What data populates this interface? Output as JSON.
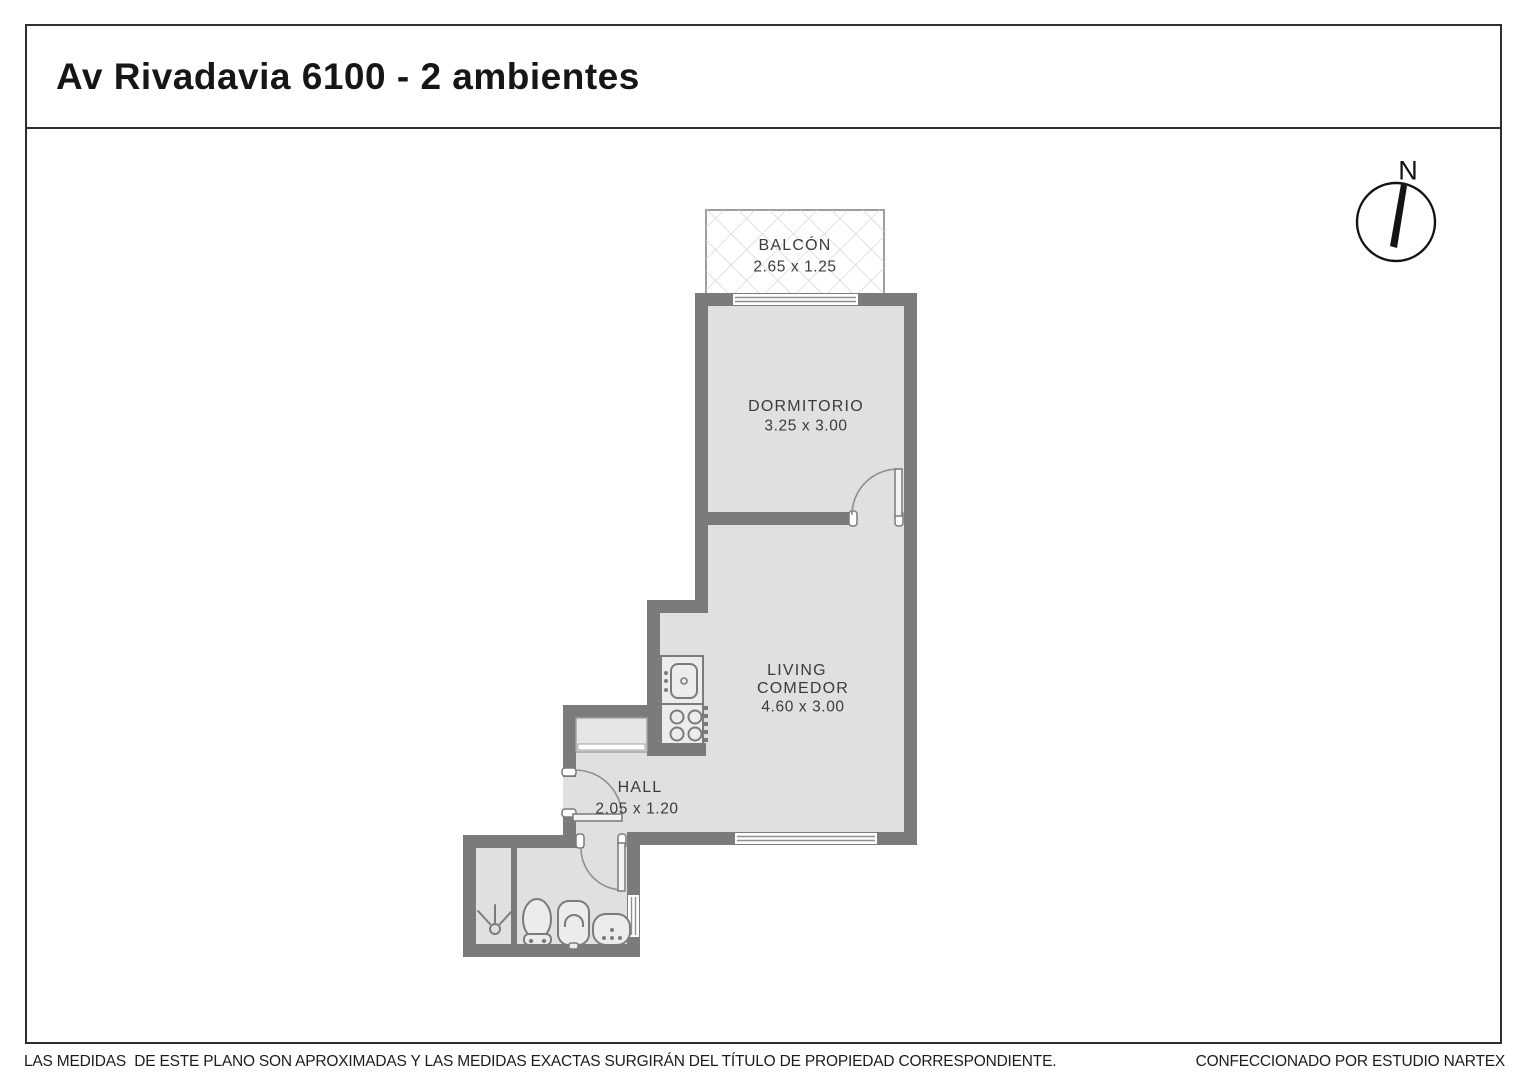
{
  "title": "Av Rivadavia 6100 - 2 ambientes",
  "rooms": {
    "balcon": {
      "name": "BALCÓN",
      "dims": "2.65 x 1.25"
    },
    "dormitorio": {
      "name": "DORMITORIO",
      "dims": "3.25 x 3.00"
    },
    "living": {
      "line1": "LIVING",
      "line2": "COMEDOR",
      "dims": "4.60 x 3.00"
    },
    "hall": {
      "name": "HALL",
      "dims": "2.05 x 1.20"
    }
  },
  "compass": {
    "label": "N"
  },
  "footer": {
    "left": "LAS MEDIDAS  DE ESTE PLANO SON APROXIMADAS Y LAS MEDIDAS EXACTAS SURGIRÁN DEL TÍTULO DE PROPIEDAD CORRESPONDIENTE.",
    "right": "CONFECCIONADO POR ESTUDIO NARTEX"
  },
  "colors": {
    "wall": "#7b7b7b",
    "floor": "#e0e0e0",
    "fixture_fill": "#ececec",
    "balcony_lattice": "#d6d6d6",
    "outline": "#2f2f2f",
    "label_text": "#3b3b3b"
  }
}
